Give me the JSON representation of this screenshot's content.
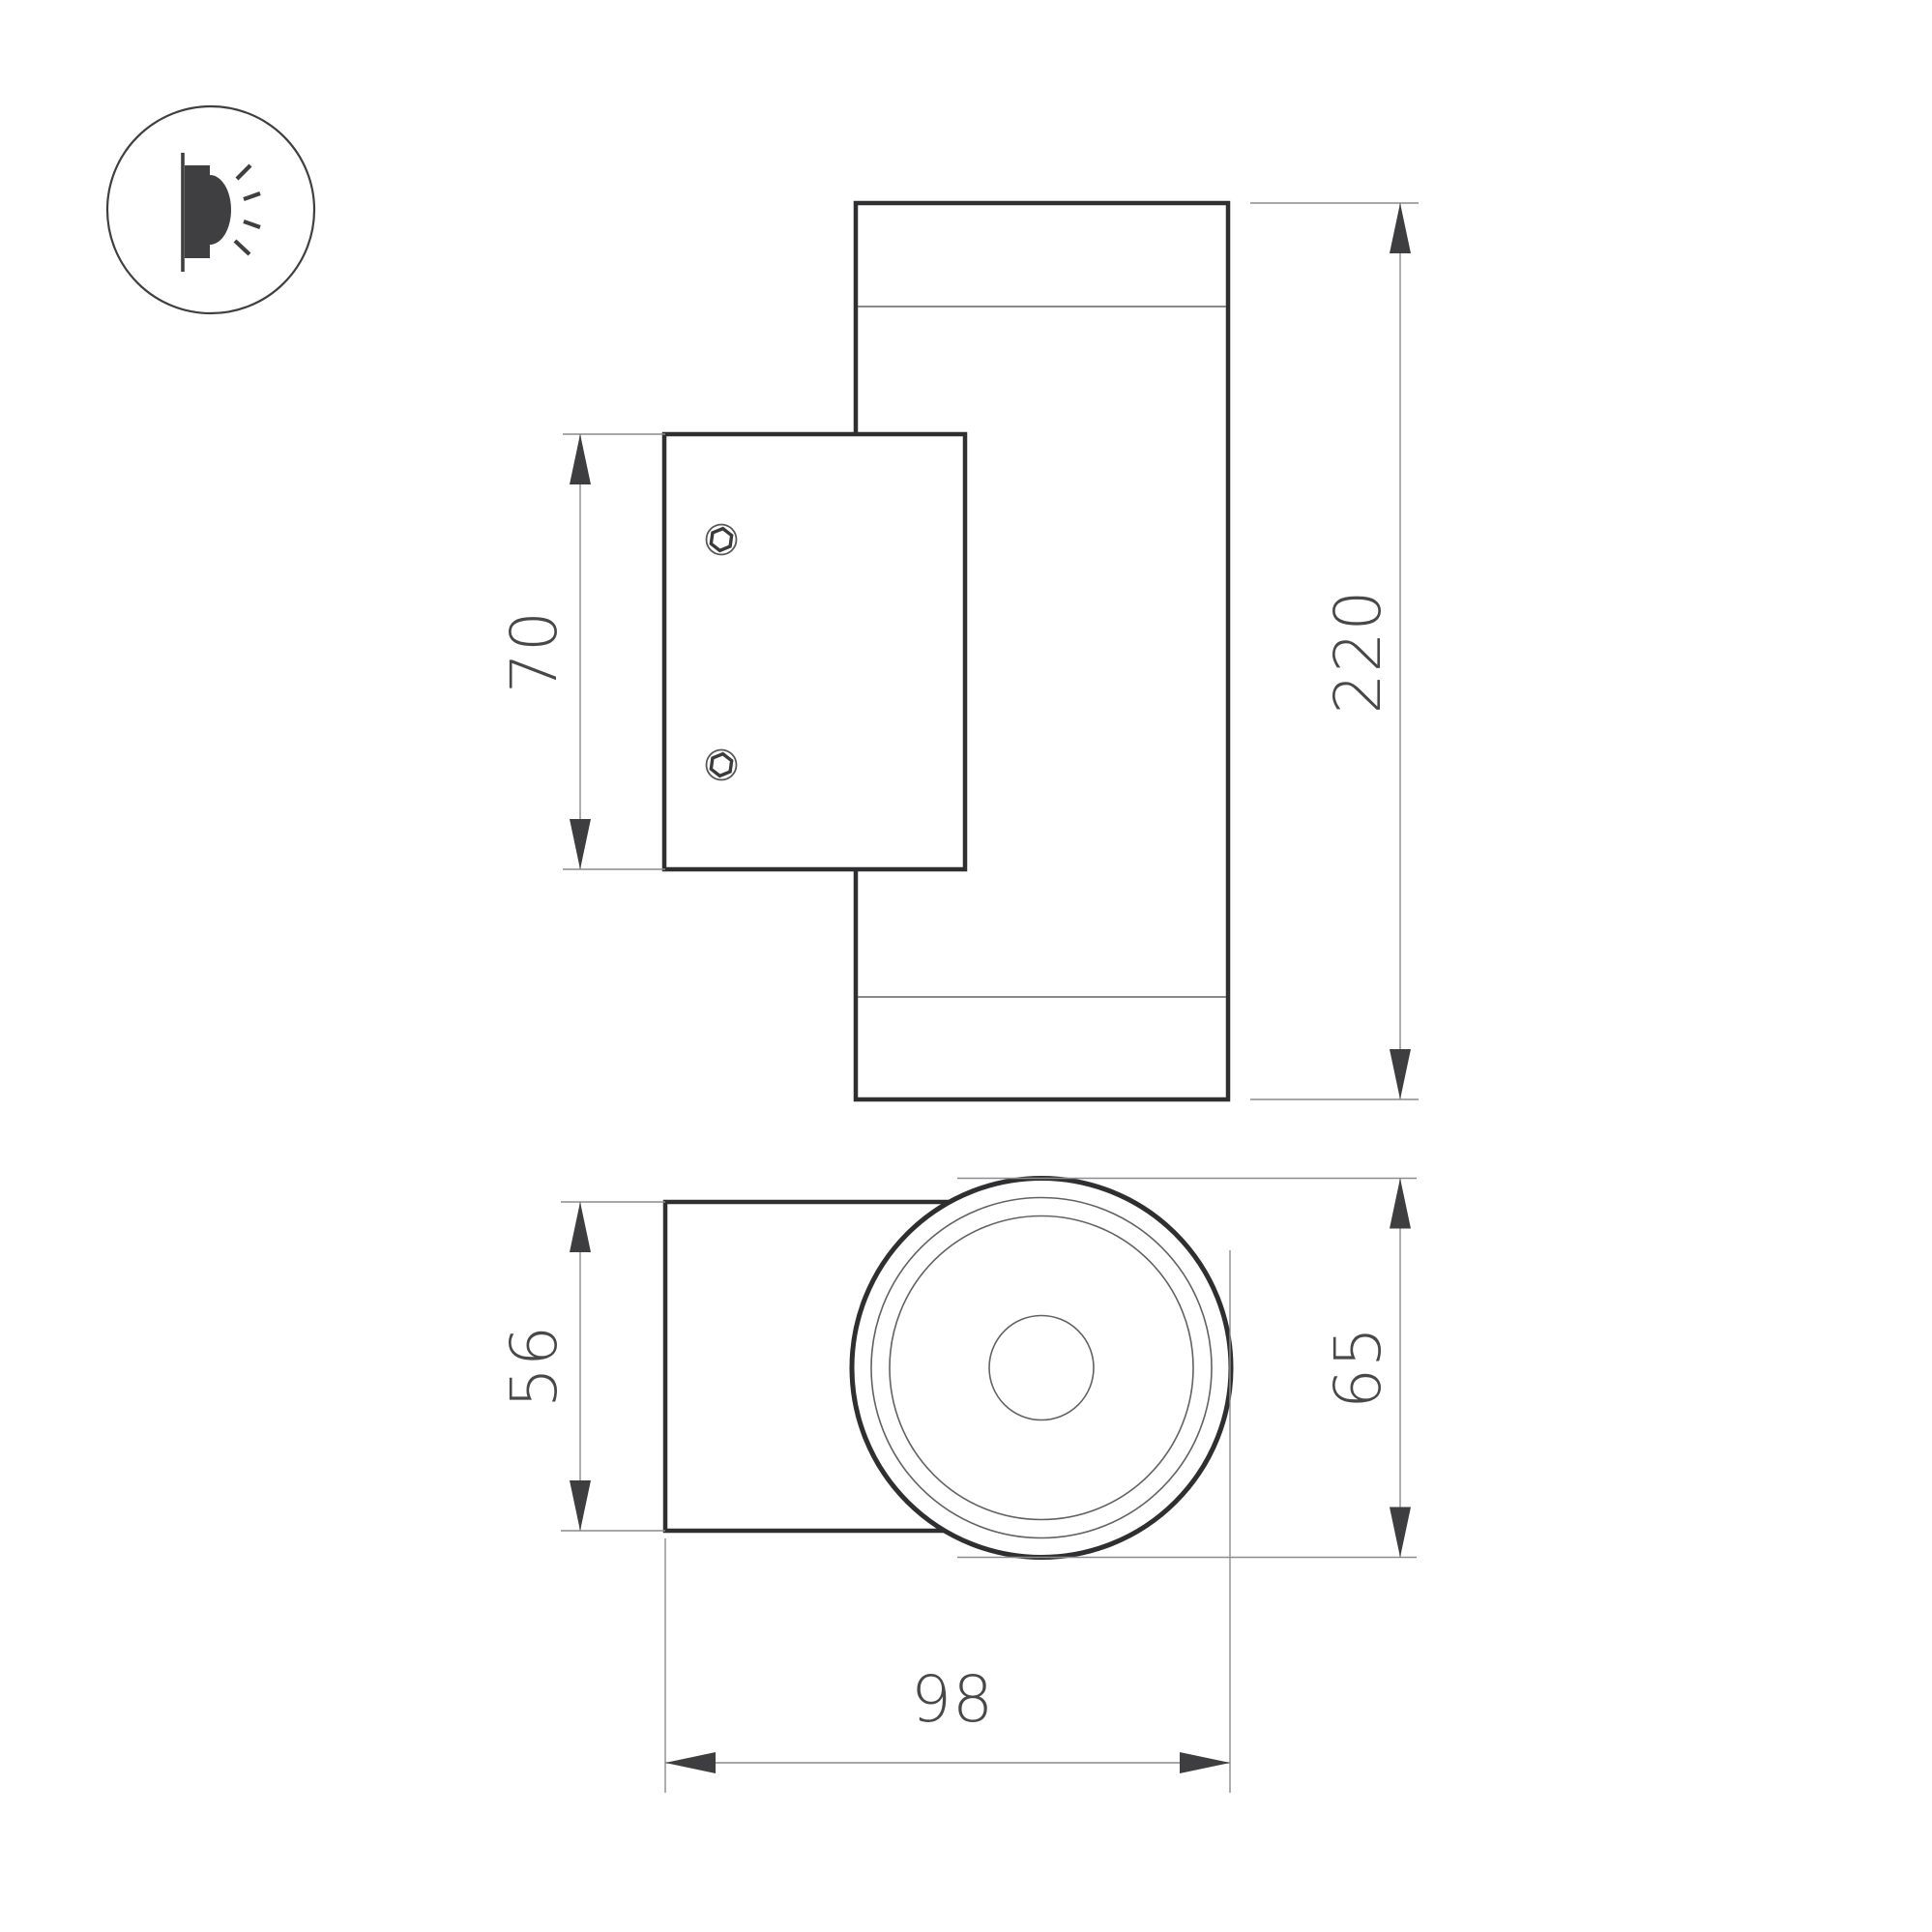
{
  "drawing": {
    "kind": "technical-dimension-drawing",
    "subject": "cylindrical-wall-luminaire",
    "background": "#ffffff"
  },
  "icon": {
    "name": "wall-light-emission-icon",
    "description": "wall bracket with light rays in circle"
  },
  "dims": {
    "plate_height": "70",
    "overall_height": "220",
    "body_depth": "56",
    "head_diameter": "65",
    "total_depth": "98"
  },
  "colors": {
    "outline": "#2f2f31",
    "thin_line": "#626264",
    "dimension_line": "#8c8c8e",
    "arrow": "#3e3e40",
    "text": "#48484a",
    "icon": "#3f3f41",
    "background": "#ffffff"
  }
}
